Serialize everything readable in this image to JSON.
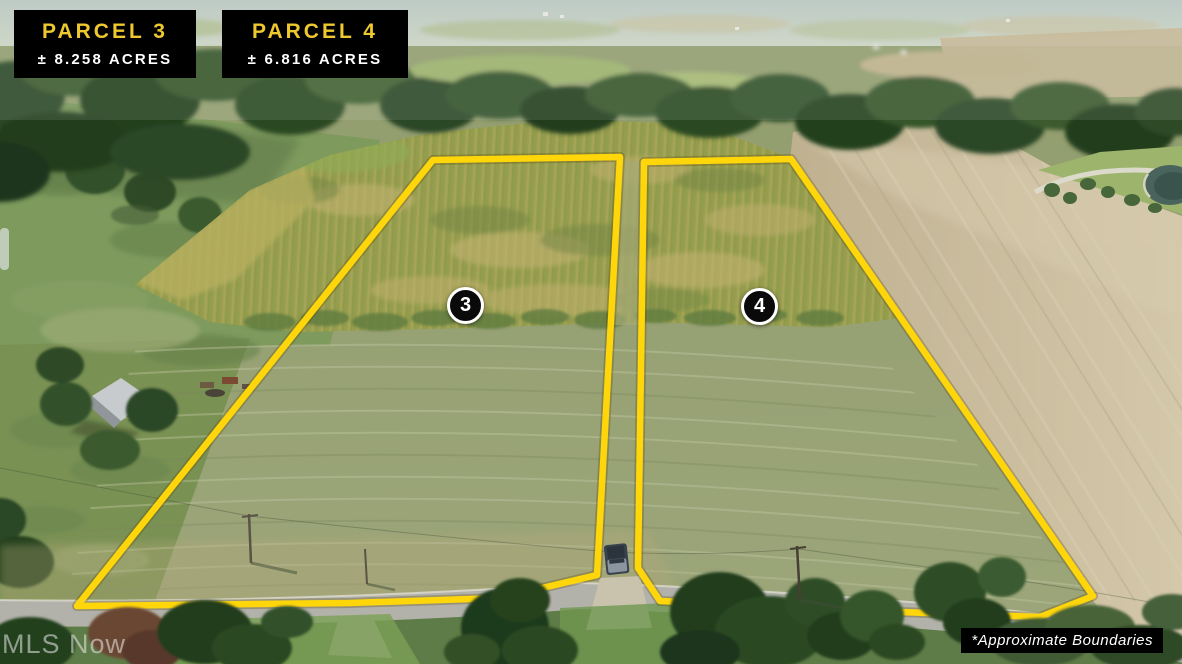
{
  "labels": {
    "parcels": [
      {
        "name": "PARCEL 3",
        "acreage": "± 8.258 ACRES",
        "badge": "3"
      },
      {
        "name": "PARCEL 4",
        "acreage": "± 6.816 ACRES",
        "badge": "4"
      }
    ],
    "watermark": "MLS Now",
    "disclaimer": "*Approximate Boundaries"
  },
  "colors": {
    "boundary_yellow": "#FFD60A",
    "label_bg": "#000000",
    "parcel_name": "#EDC82F",
    "acreage_text": "#FFFFFF",
    "badge_bg": "#0A0A0A",
    "badge_border": "#FFFFFF",
    "badge_text": "#FFFFFF",
    "disclaimer_bg": "#000000",
    "disclaimer_text": "#FFFFFF",
    "watermark_text": "#EBEBEB"
  }
}
